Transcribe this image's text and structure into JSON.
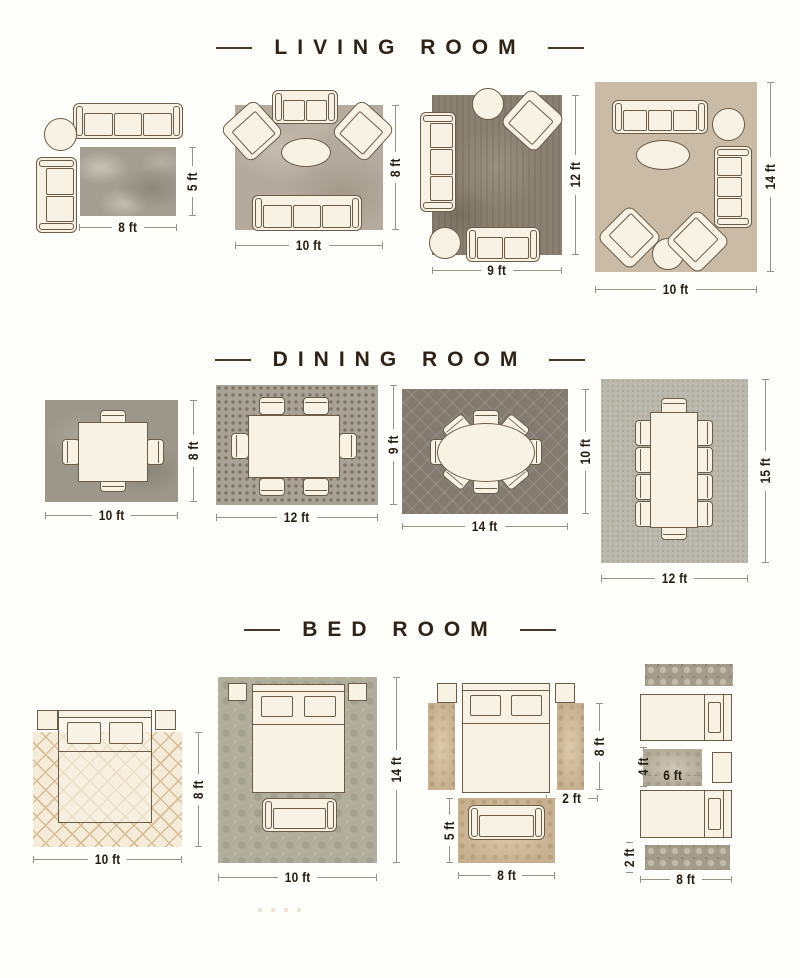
{
  "page": {
    "background": "#fdfdfa"
  },
  "colors": {
    "title_text": "#2f2318",
    "dimension_label": "#241c11",
    "dimension_line": "#979288",
    "furniture_fill": "#f8f2e4",
    "furniture_outline": "#6b5c48"
  },
  "sections": [
    {
      "title": "LIVING ROOM",
      "layouts": [
        {
          "name": "living-rug-8x5",
          "width_label": "8 ft",
          "height_label": "5 ft"
        },
        {
          "name": "living-rug-10x8",
          "width_label": "10 ft",
          "height_label": "8 ft"
        },
        {
          "name": "living-rug-9x12",
          "width_label": "9 ft",
          "height_label": "12 ft"
        },
        {
          "name": "living-rug-10x14",
          "width_label": "10 ft",
          "height_label": "14 ft"
        }
      ]
    },
    {
      "title": "DINING ROOM",
      "layouts": [
        {
          "name": "dining-rug-10x8",
          "width_label": "10 ft",
          "height_label": "8 ft"
        },
        {
          "name": "dining-rug-12x9",
          "width_label": "12 ft",
          "height_label": "9 ft"
        },
        {
          "name": "dining-rug-14x10",
          "width_label": "14 ft",
          "height_label": "10 ft"
        },
        {
          "name": "dining-rug-12x15",
          "width_label": "12 ft",
          "height_label": "15 ft"
        }
      ]
    },
    {
      "title": "BED ROOM",
      "layouts": [
        {
          "name": "bedroom-rug-10x8",
          "width_label": "10 ft",
          "height_label": "8 ft"
        },
        {
          "name": "bedroom-rug-10x14",
          "width_label": "10 ft",
          "height_label": "14 ft"
        },
        {
          "name": "bedroom-runners-and-foot-rug",
          "bed_height_label": "8 ft",
          "runner_width_label": "2 ft",
          "foot_rug_height_label": "5 ft",
          "foot_rug_width_label": "8 ft"
        },
        {
          "name": "bedroom-twin-beds",
          "mid_rug_height_label": "4 ft",
          "mid_rug_width_label": "6 ft",
          "runner_height_label": "2 ft",
          "width_label": "8 ft"
        }
      ]
    }
  ]
}
